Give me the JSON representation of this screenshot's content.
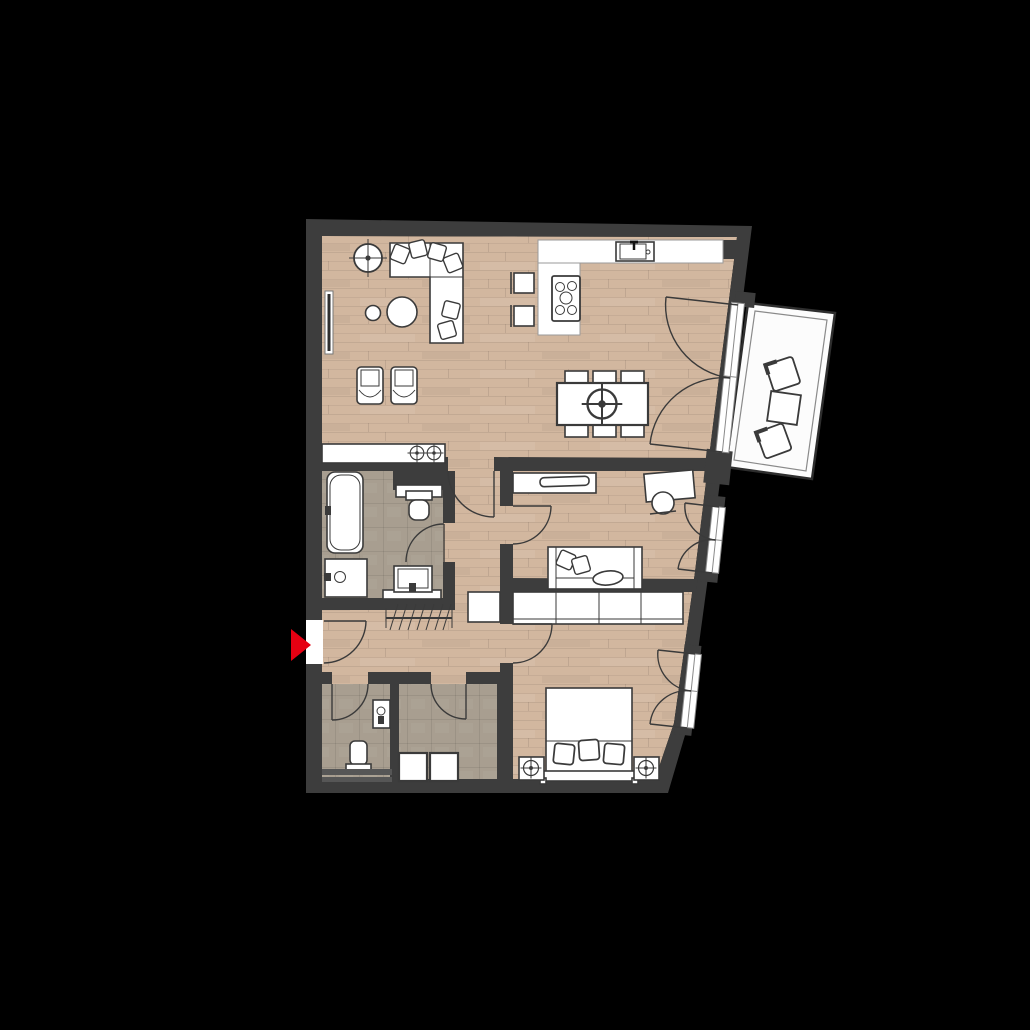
{
  "scene": {
    "type": "apartment-floor-plan",
    "view": "top-down",
    "background": "#000000",
    "has_text_labels": false
  },
  "colors": {
    "background": "#000000",
    "wall": "#3d3d3d",
    "wood": "#d2b79f",
    "wood_dark_line": "#b89c84",
    "tile": "#a89e90",
    "white": "#ffffff",
    "line": "#3a3a3a",
    "arrow": "#e60012",
    "balcony_floor": "#fcfcfc"
  },
  "markers": {
    "entrance_arrow": {
      "shape": "triangle",
      "direction": "right",
      "color": "#e60012"
    }
  },
  "rooms": [
    {
      "id": "living-dining-kitchen",
      "floor": "wood",
      "furniture": [
        "potted-plant",
        "l-shaped-sofa",
        "throw-pillows",
        "coffee-table-round",
        "side-table-round",
        "wall-tv",
        "armchair",
        "armchair",
        "sideboard-with-two-lamps",
        "kitchen-counter-with-sink",
        "kitchen-island-cooktop",
        "bar-stool",
        "bar-stool",
        "dining-table-six-chairs",
        "ceiling-lamp"
      ]
    },
    {
      "id": "bathroom",
      "floor": "tile",
      "furniture": [
        "bathtub",
        "installation-shaft",
        "toilet-with-cistern",
        "washbasin",
        "vanity-basin"
      ]
    },
    {
      "id": "office-guest-room",
      "floor": "wood",
      "furniture": [
        "tv-lowboard",
        "desk",
        "desk-chair",
        "two-seat-sofa",
        "throw-pillows"
      ]
    },
    {
      "id": "bedroom",
      "floor": "wood",
      "furniture": [
        "wardrobe-four-sections",
        "double-bed",
        "pillows",
        "nightstand-with-lamp",
        "nightstand-with-lamp"
      ]
    },
    {
      "id": "hallway",
      "floor": "wood",
      "furniture": [
        "coat-rack",
        "cabinet"
      ]
    },
    {
      "id": "wc",
      "floor": "tile",
      "furniture": [
        "toilet",
        "small-washbasin",
        "shelf-bench"
      ]
    },
    {
      "id": "storage-utility",
      "floor": "tile",
      "furniture": [
        "washing-machine",
        "dryer"
      ]
    },
    {
      "id": "balcony",
      "floor": "white",
      "furniture": [
        "balcony-chair",
        "balcony-table",
        "balcony-chair"
      ]
    }
  ],
  "openings": [
    "entrance-door",
    "living-to-hall-door",
    "bathroom-door",
    "office-door",
    "bedroom-door",
    "wc-door",
    "storage-door",
    "balcony-french-door",
    "office-french-window",
    "bedroom-french-window"
  ]
}
